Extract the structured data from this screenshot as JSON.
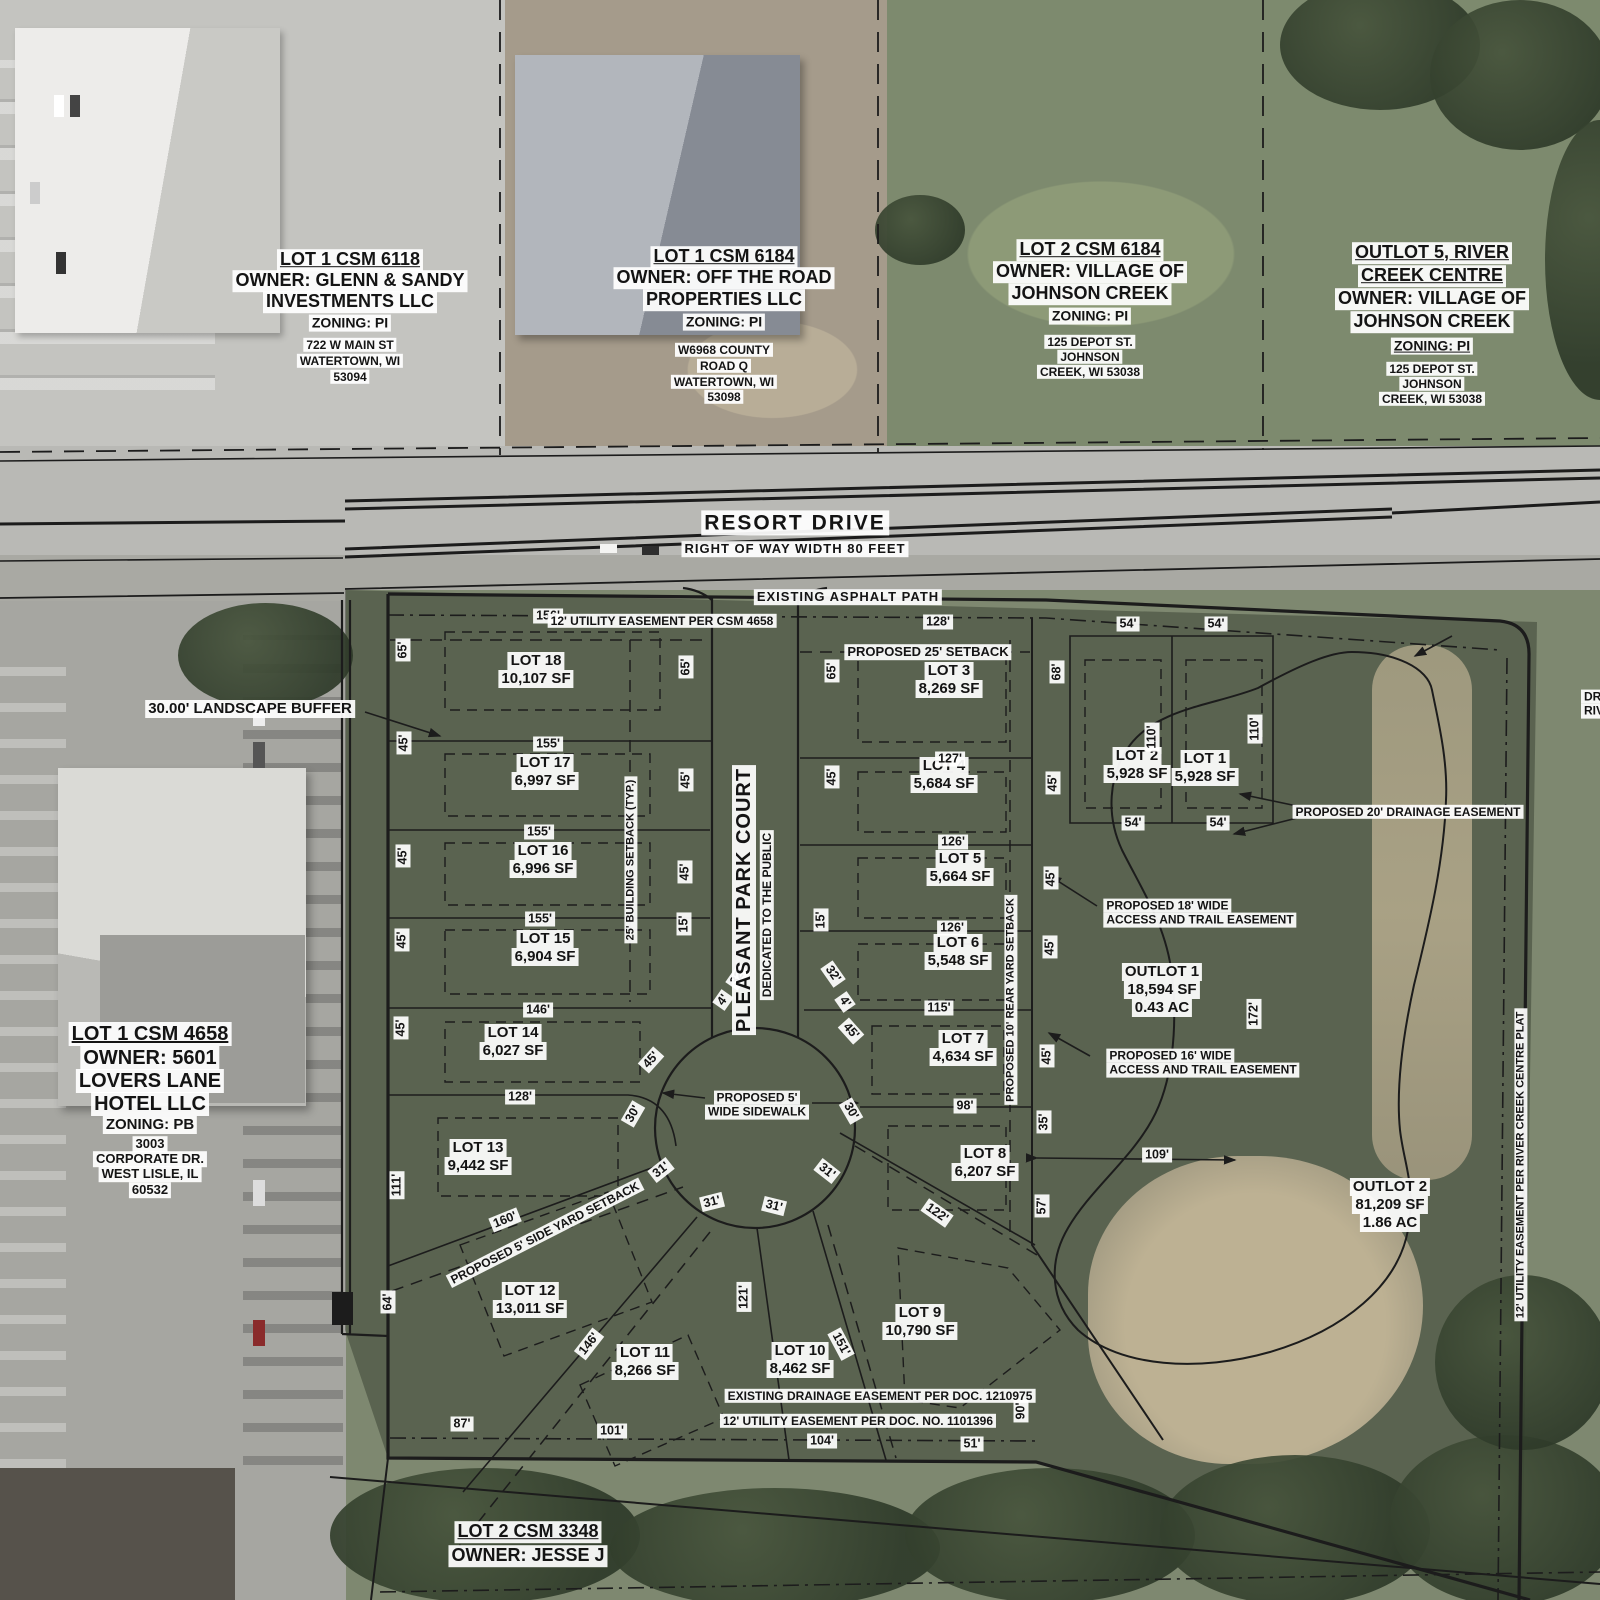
{
  "map": {
    "colors": {
      "label_bg": "#ffffff",
      "line": "#1c1c1c",
      "site_overlay_green": "#2a3024",
      "pond_tan": "#bdb193"
    },
    "road": {
      "name": "RESORT DRIVE",
      "right_of_way": "RIGHT OF WAY WIDTH 80 FEET"
    },
    "court": {
      "name": "PLEASANT PARK COURT",
      "dedication": "DEDICATED TO THE PUBLIC"
    },
    "parcels": [
      {
        "id": "lot-1-csm-6118",
        "x": 350,
        "lines": [
          {
            "t": "LOT 1 CSM 6118",
            "y": 260,
            "fs": 18,
            "u": 1
          },
          {
            "t": "OWNER: GLENN & SANDY",
            "y": 281,
            "fs": 18
          },
          {
            "t": "INVESTMENTS LLC",
            "y": 302,
            "fs": 18
          },
          {
            "t": "ZONING: PI",
            "y": 323,
            "fs": 14
          },
          {
            "t": "722 W MAIN ST",
            "y": 345,
            "fs": 12
          },
          {
            "t": "WATERTOWN, WI",
            "y": 361,
            "fs": 12
          },
          {
            "t": "53094",
            "y": 377,
            "fs": 12
          }
        ]
      },
      {
        "id": "lot-1-csm-6184",
        "x": 724,
        "lines": [
          {
            "t": "LOT 1 CSM 6184",
            "y": 257,
            "fs": 18,
            "u": 1
          },
          {
            "t": "OWNER: OFF THE ROAD",
            "y": 278,
            "fs": 18
          },
          {
            "t": "PROPERTIES LLC",
            "y": 300,
            "fs": 18
          },
          {
            "t": "ZONING: PI",
            "y": 322,
            "fs": 14
          },
          {
            "t": "W6968 COUNTY",
            "y": 350,
            "fs": 12
          },
          {
            "t": "ROAD Q",
            "y": 366,
            "fs": 12
          },
          {
            "t": "WATERTOWN, WI",
            "y": 382,
            "fs": 12
          },
          {
            "t": "53098",
            "y": 397,
            "fs": 12
          }
        ]
      },
      {
        "id": "lot-2-csm-6184",
        "x": 1090,
        "lines": [
          {
            "t": "LOT 2 CSM 6184",
            "y": 250,
            "fs": 18,
            "u": 1
          },
          {
            "t": "OWNER: VILLAGE OF",
            "y": 272,
            "fs": 18
          },
          {
            "t": "JOHNSON CREEK",
            "y": 294,
            "fs": 18
          },
          {
            "t": "ZONING: PI",
            "y": 316,
            "fs": 14
          },
          {
            "t": "125 DEPOT ST.",
            "y": 342,
            "fs": 12
          },
          {
            "t": "JOHNSON",
            "y": 357,
            "fs": 12
          },
          {
            "t": "CREEK, WI 53038",
            "y": 372,
            "fs": 12
          }
        ]
      },
      {
        "id": "outlot-5-river-creek-centre",
        "x": 1432,
        "lines": [
          {
            "t": "OUTLOT 5, RIVER",
            "y": 253,
            "fs": 18,
            "u": 1
          },
          {
            "t": "CREEK CENTRE",
            "y": 276,
            "fs": 18,
            "u": 1
          },
          {
            "t": "OWNER: VILLAGE OF",
            "y": 299,
            "fs": 18
          },
          {
            "t": "JOHNSON CREEK",
            "y": 322,
            "fs": 18
          },
          {
            "t": "ZONING: PI",
            "y": 346,
            "fs": 14,
            "u": 1
          },
          {
            "t": "125 DEPOT ST.",
            "y": 369,
            "fs": 12
          },
          {
            "t": "JOHNSON",
            "y": 384,
            "fs": 12
          },
          {
            "t": "CREEK, WI 53038",
            "y": 399,
            "fs": 12
          }
        ]
      },
      {
        "id": "lot-1-csm-4658",
        "x": 150,
        "lines": [
          {
            "t": "LOT 1 CSM 4658",
            "y": 1034,
            "fs": 20,
            "u": 1
          },
          {
            "t": "OWNER: 5601",
            "y": 1058,
            "fs": 20
          },
          {
            "t": "LOVERS LANE",
            "y": 1081,
            "fs": 20
          },
          {
            "t": "HOTEL LLC",
            "y": 1104,
            "fs": 20
          },
          {
            "t": "ZONING: PB",
            "y": 1125,
            "fs": 15
          },
          {
            "t": "3003",
            "y": 1144,
            "fs": 13
          },
          {
            "t": "CORPORATE DR.",
            "y": 1159,
            "fs": 13
          },
          {
            "t": "WEST LISLE, IL",
            "y": 1174,
            "fs": 13
          },
          {
            "t": "60532",
            "y": 1190,
            "fs": 13
          }
        ]
      },
      {
        "id": "lot-2-csm-3348",
        "x": 528,
        "lines": [
          {
            "t": "LOT 2 CSM 3348",
            "y": 1532,
            "fs": 18,
            "u": 1
          },
          {
            "t": "OWNER: JESSE J",
            "y": 1556,
            "fs": 18
          }
        ]
      }
    ],
    "lots": [
      {
        "name": "LOT 18",
        "area": "10,107 SF",
        "x": 536,
        "y": 670
      },
      {
        "name": "LOT 17",
        "area": "6,997 SF",
        "x": 545,
        "y": 772
      },
      {
        "name": "LOT 16",
        "area": "6,996 SF",
        "x": 543,
        "y": 860
      },
      {
        "name": "LOT 15",
        "area": "6,904 SF",
        "x": 545,
        "y": 948
      },
      {
        "name": "LOT 14",
        "area": "6,027 SF",
        "x": 513,
        "y": 1042
      },
      {
        "name": "LOT 13",
        "area": "9,442 SF",
        "x": 478,
        "y": 1157
      },
      {
        "name": "LOT 12",
        "area": "13,011 SF",
        "x": 530,
        "y": 1300
      },
      {
        "name": "LOT 11",
        "area": "8,266 SF",
        "x": 645,
        "y": 1362
      },
      {
        "name": "LOT 10",
        "area": "8,462 SF",
        "x": 800,
        "y": 1360
      },
      {
        "name": "LOT 9",
        "area": "10,790 SF",
        "x": 920,
        "y": 1322
      },
      {
        "name": "LOT 8",
        "area": "6,207 SF",
        "x": 985,
        "y": 1163
      },
      {
        "name": "LOT 7",
        "area": "4,634 SF",
        "x": 963,
        "y": 1048
      },
      {
        "name": "LOT 6",
        "area": "5,548 SF",
        "x": 958,
        "y": 952
      },
      {
        "name": "LOT 5",
        "area": "5,664 SF",
        "x": 960,
        "y": 868
      },
      {
        "name": "LOT 4",
        "area": "5,684 SF",
        "x": 944,
        "y": 775
      },
      {
        "name": "LOT 3",
        "area": "8,269 SF",
        "x": 949,
        "y": 680
      },
      {
        "name": "LOT 2",
        "area": "5,928 SF",
        "x": 1137,
        "y": 765
      },
      {
        "name": "LOT 1",
        "area": "5,928 SF",
        "x": 1205,
        "y": 768
      }
    ],
    "outlots": [
      {
        "name": "OUTLOT 1",
        "area": "18,594 SF",
        "acres": "0.43 AC",
        "x": 1162,
        "y": 990
      },
      {
        "name": "OUTLOT 2",
        "area": "81,209 SF",
        "acres": "1.86 AC",
        "x": 1390,
        "y": 1205
      }
    ],
    "annotations": [
      {
        "id": "resort-drive-name",
        "lines": [
          "RESORT DRIVE"
        ],
        "x": 795,
        "y": 523,
        "fs": 21,
        "sp": 2
      },
      {
        "id": "right-of-way-width",
        "lines": [
          "RIGHT OF WAY WIDTH 80 FEET"
        ],
        "x": 795,
        "y": 549,
        "fs": 13,
        "sp": 1
      },
      {
        "id": "existing-asphalt-path",
        "lines": [
          "EXISTING ASPHALT PATH"
        ],
        "x": 848,
        "y": 597,
        "fs": 13,
        "sp": 1
      },
      {
        "id": "utility-easement-csm-4658",
        "lines": [
          "12' UTILITY EASEMENT PER CSM 4658"
        ],
        "x": 662,
        "y": 621,
        "fs": 12
      },
      {
        "id": "proposed-25-setback",
        "lines": [
          "PROPOSED 25' SETBACK"
        ],
        "x": 928,
        "y": 652,
        "fs": 13
      },
      {
        "id": "landscape-buffer",
        "lines": [
          "30.00' LANDSCAPE BUFFER"
        ],
        "x": 250,
        "y": 709,
        "fs": 15
      },
      {
        "id": "proposed-20-drainage-easement",
        "lines": [
          "PROPOSED 20' DRAINAGE EASEMENT"
        ],
        "x": 1408,
        "y": 812,
        "fs": 12
      },
      {
        "id": "proposed-18-access-trail-easement",
        "lines": [
          "PROPOSED 18' WIDE",
          "ACCESS AND TRAIL EASEMENT"
        ],
        "x": 1200,
        "y": 913,
        "fs": 12,
        "align": "left"
      },
      {
        "id": "proposed-16-access-trail-easement",
        "lines": [
          "PROPOSED 16' WIDE",
          "ACCESS AND TRAIL EASEMENT"
        ],
        "x": 1203,
        "y": 1063,
        "fs": 12,
        "align": "left"
      },
      {
        "id": "proposed-5-sidewalk",
        "lines": [
          "PROPOSED 5'",
          "WIDE SIDEWALK"
        ],
        "x": 757,
        "y": 1105,
        "fs": 12
      },
      {
        "id": "existing-drainage-easement-doc",
        "lines": [
          "EXISTING DRAINAGE EASEMENT PER DOC. 1210975"
        ],
        "x": 880,
        "y": 1396,
        "fs": 12
      },
      {
        "id": "utility-easement-doc-1101396",
        "lines": [
          "12' UTILITY EASEMENT PER DOC. NO. 1101396"
        ],
        "x": 858,
        "y": 1421,
        "fs": 12
      },
      {
        "id": "pleasant-park-court-name",
        "lines": [
          "PLEASANT PARK COURT"
        ],
        "x": 744,
        "y": 900,
        "fs": 20,
        "rot": -90,
        "sp": 1
      },
      {
        "id": "dedicated-to-the-public",
        "lines": [
          "DEDICATED TO THE PUBLIC"
        ],
        "x": 767,
        "y": 915,
        "fs": 12,
        "rot": -90
      },
      {
        "id": "building-setback-typ",
        "lines": [
          "25' BUILDING SETBACK (TYP.)"
        ],
        "x": 631,
        "y": 860,
        "fs": 11,
        "rot": -90
      },
      {
        "id": "rear-yard-setback",
        "lines": [
          "PROPOSED 10' REAR YARD SETBACK"
        ],
        "x": 1011,
        "y": 1000,
        "fs": 11,
        "rot": -90
      },
      {
        "id": "side-yard-setback",
        "lines": [
          "PROPOSED 5' SIDE YARD SETBACK"
        ],
        "x": 545,
        "y": 1233,
        "fs": 12,
        "rot": -27
      },
      {
        "id": "utility-easement-river-creek-centre-plat",
        "lines": [
          "12' UTILITY EASEMENT PER RIVER CREEK CENTRE PLAT"
        ],
        "x": 1521,
        "y": 1165,
        "fs": 11,
        "rot": -90
      },
      {
        "id": "edge-cutoff-text",
        "lines": [
          "DR",
          "RIV"
        ],
        "x": 1594,
        "y": 704,
        "fs": 12,
        "align": "left"
      }
    ],
    "dimensions": [
      {
        "t": "156'",
        "x": 548,
        "y": 616
      },
      {
        "t": "128'",
        "x": 938,
        "y": 622
      },
      {
        "t": "54'",
        "x": 1128,
        "y": 624
      },
      {
        "t": "54'",
        "x": 1216,
        "y": 624
      },
      {
        "t": "65'",
        "x": 403,
        "y": 650,
        "r": -90
      },
      {
        "t": "45'",
        "x": 404,
        "y": 743,
        "r": -90
      },
      {
        "t": "45'",
        "x": 403,
        "y": 856,
        "r": -90
      },
      {
        "t": "45'",
        "x": 402,
        "y": 940,
        "r": -90
      },
      {
        "t": "45'",
        "x": 401,
        "y": 1028,
        "r": -90
      },
      {
        "t": "111'",
        "x": 397,
        "y": 1185,
        "r": -90
      },
      {
        "t": "64'",
        "x": 388,
        "y": 1302,
        "r": -90
      },
      {
        "t": "65'",
        "x": 686,
        "y": 667,
        "r": -90
      },
      {
        "t": "45'",
        "x": 686,
        "y": 780,
        "r": -90
      },
      {
        "t": "45'",
        "x": 685,
        "y": 872,
        "r": -90
      },
      {
        "t": "15'",
        "x": 684,
        "y": 924,
        "r": -90
      },
      {
        "t": "32'",
        "x": 738,
        "y": 977,
        "r": -55
      },
      {
        "t": "4'",
        "x": 723,
        "y": 1000,
        "r": -55
      },
      {
        "t": "45'",
        "x": 651,
        "y": 1060,
        "r": -48
      },
      {
        "t": "155'",
        "x": 548,
        "y": 744
      },
      {
        "t": "155'",
        "x": 539,
        "y": 832
      },
      {
        "t": "155'",
        "x": 540,
        "y": 919
      },
      {
        "t": "146'",
        "x": 538,
        "y": 1010
      },
      {
        "t": "128'",
        "x": 520,
        "y": 1097
      },
      {
        "t": "160'",
        "x": 505,
        "y": 1220,
        "r": -22
      },
      {
        "t": "65'",
        "x": 832,
        "y": 671,
        "r": -90
      },
      {
        "t": "45'",
        "x": 832,
        "y": 777,
        "r": -90
      },
      {
        "t": "15'",
        "x": 821,
        "y": 920,
        "r": -90
      },
      {
        "t": "32'",
        "x": 833,
        "y": 974,
        "r": 55
      },
      {
        "t": "4'",
        "x": 845,
        "y": 1002,
        "r": 55
      },
      {
        "t": "45'",
        "x": 851,
        "y": 1031,
        "r": 48
      },
      {
        "t": "68'",
        "x": 1057,
        "y": 672,
        "r": -90
      },
      {
        "t": "45'",
        "x": 1053,
        "y": 783,
        "r": -90
      },
      {
        "t": "45'",
        "x": 1051,
        "y": 878,
        "r": -90
      },
      {
        "t": "45'",
        "x": 1050,
        "y": 947,
        "r": -90
      },
      {
        "t": "45'",
        "x": 1047,
        "y": 1056,
        "r": -90
      },
      {
        "t": "35'",
        "x": 1044,
        "y": 1122,
        "r": -90
      },
      {
        "t": "57'",
        "x": 1042,
        "y": 1206,
        "r": -90
      },
      {
        "t": "127'",
        "x": 950,
        "y": 759
      },
      {
        "t": "126'",
        "x": 953,
        "y": 842
      },
      {
        "t": "126'",
        "x": 952,
        "y": 928
      },
      {
        "t": "115'",
        "x": 939,
        "y": 1008
      },
      {
        "t": "98'",
        "x": 965,
        "y": 1106
      },
      {
        "t": "122'",
        "x": 937,
        "y": 1213,
        "r": 35
      },
      {
        "t": "54'",
        "x": 1133,
        "y": 823
      },
      {
        "t": "54'",
        "x": 1218,
        "y": 823
      },
      {
        "t": "110'",
        "x": 1152,
        "y": 737,
        "r": -90
      },
      {
        "t": "110'",
        "x": 1255,
        "y": 729,
        "r": -90
      },
      {
        "t": "172'",
        "x": 1254,
        "y": 1014,
        "r": -90
      },
      {
        "t": "109'",
        "x": 1157,
        "y": 1155
      },
      {
        "t": "30'",
        "x": 633,
        "y": 1114,
        "r": -60
      },
      {
        "t": "31'",
        "x": 661,
        "y": 1170,
        "r": -38
      },
      {
        "t": "31'",
        "x": 712,
        "y": 1202,
        "r": -14
      },
      {
        "t": "31'",
        "x": 774,
        "y": 1206,
        "r": 14
      },
      {
        "t": "31'",
        "x": 827,
        "y": 1171,
        "r": 38
      },
      {
        "t": "30'",
        "x": 851,
        "y": 1111,
        "r": 60
      },
      {
        "t": "121'",
        "x": 744,
        "y": 1297,
        "r": -90
      },
      {
        "t": "146'",
        "x": 589,
        "y": 1344,
        "r": -52
      },
      {
        "t": "151'",
        "x": 841,
        "y": 1344,
        "r": 62
      },
      {
        "t": "87'",
        "x": 462,
        "y": 1424
      },
      {
        "t": "101'",
        "x": 612,
        "y": 1431
      },
      {
        "t": "104'",
        "x": 822,
        "y": 1441
      },
      {
        "t": "51'",
        "x": 972,
        "y": 1444
      },
      {
        "t": "90'",
        "x": 1021,
        "y": 1411,
        "r": -90
      }
    ]
  }
}
